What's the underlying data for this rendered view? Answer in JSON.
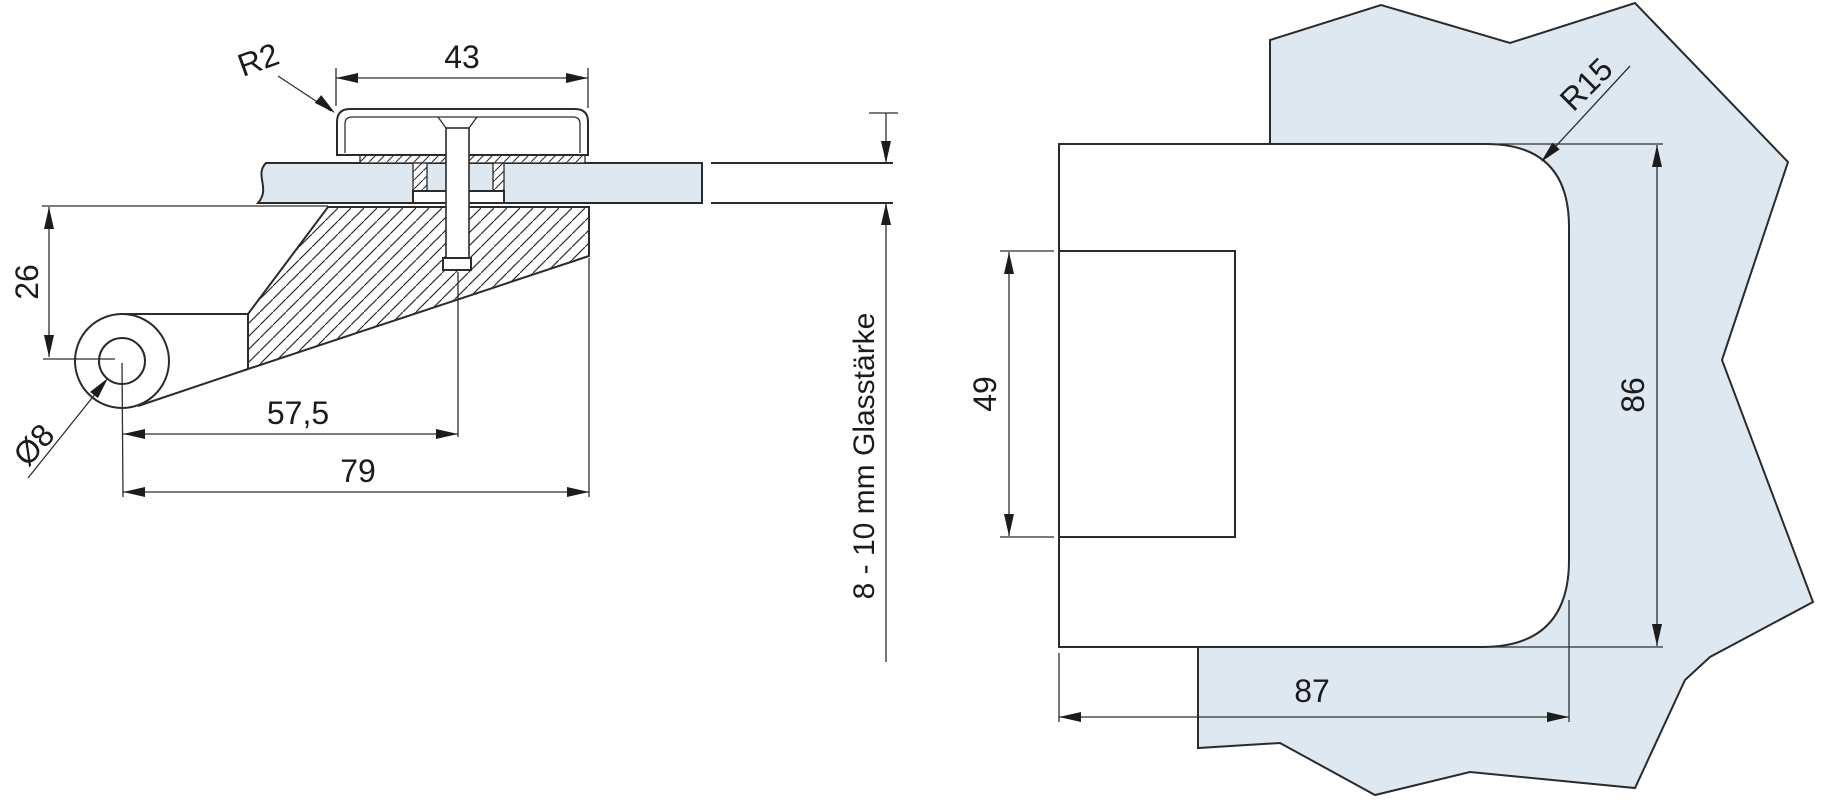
{
  "colors": {
    "glass": "#dde8f1",
    "line": "#2b2b2b"
  },
  "side_view": {
    "labels": {
      "cap_radius": "R2",
      "cap_width": "43",
      "pivot_drop": "26",
      "pivot_hole_diameter": "Ø8",
      "pivot_to_screw": "57,5",
      "pivot_to_body_edge": "79",
      "glass_thickness": "8 - 10 mm Glasstärke"
    }
  },
  "front_view": {
    "labels": {
      "corner_radius": "R15",
      "plate_height": "49",
      "body_height": "86",
      "body_width": "87"
    }
  }
}
